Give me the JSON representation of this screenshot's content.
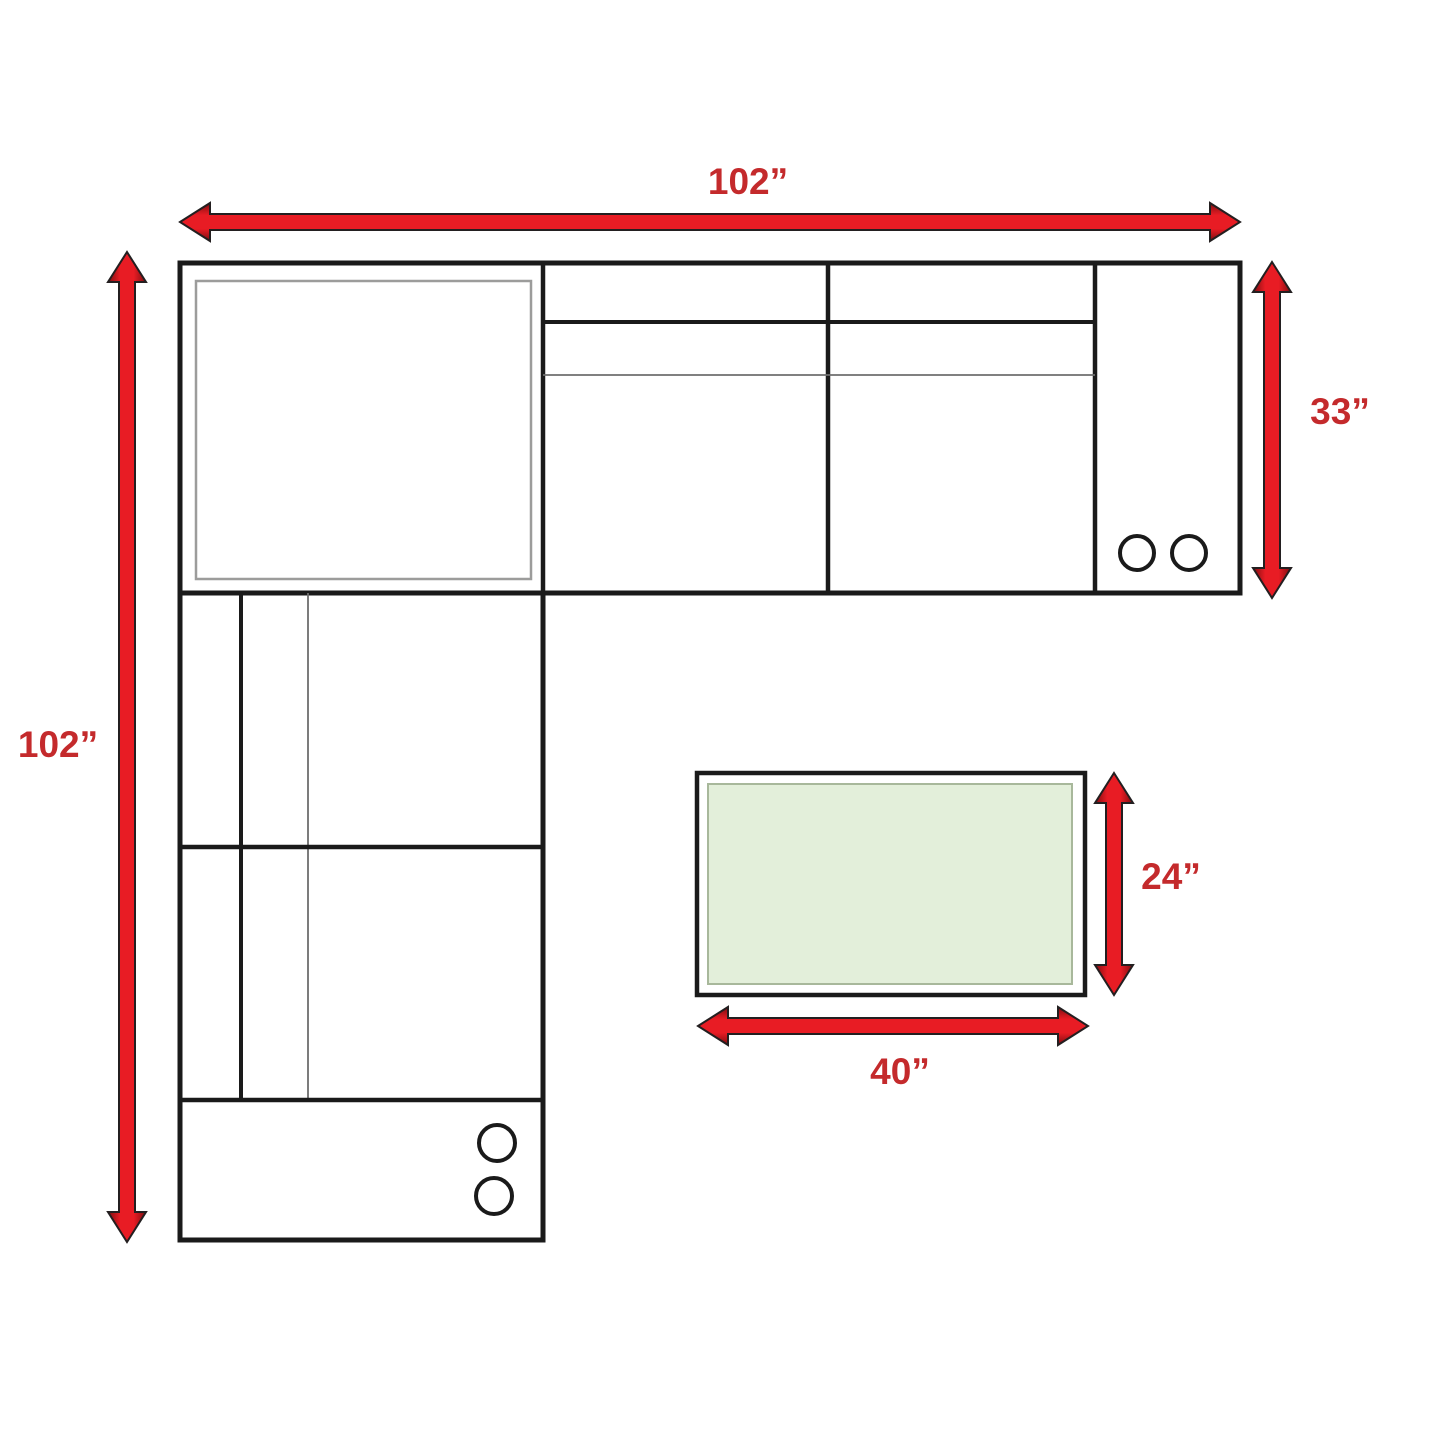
{
  "diagram": {
    "type": "furniture-dimension-diagram",
    "subject": "L-shaped sectional sofa top view with coffee table",
    "labels": {
      "sectional_width": "102”",
      "sectional_depth": "102”",
      "sectional_side_depth": "33”",
      "table_depth": "24”",
      "table_width": "40”"
    },
    "icons": {
      "cup_holders_right_console": 2,
      "cup_holders_bottom_console": 2
    },
    "colors": {
      "arrow_fill": "#e81c24",
      "arrow_dark": "#7c0d10",
      "arrow_stroke": "#231f20",
      "label_color": "#c42a2c",
      "line_color": "#1a1a1a",
      "thin_line_color": "#6e6e6e",
      "inner_frame_color": "#9c9c9b",
      "table_fill": "#e3efda",
      "table_frame_color": "#a8b89b",
      "background": "#ffffff"
    }
  }
}
